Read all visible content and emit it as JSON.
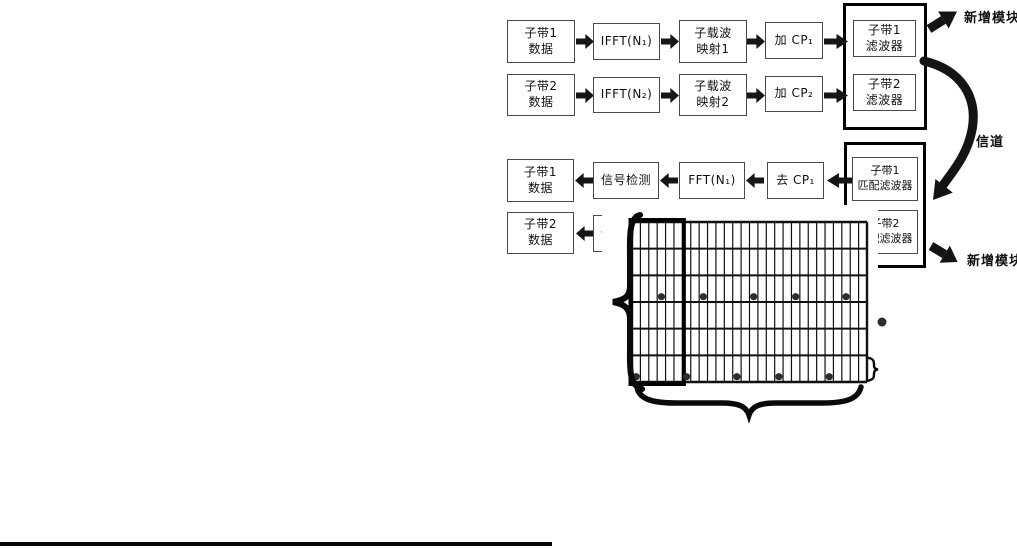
{
  "diagram": {
    "transmitter": {
      "chains": [
        {
          "boxes": [
            "子带1\n数据",
            "IFFT(N₁)",
            "子载波\n映射1",
            "加 CP₁",
            "子带1\n滤波器"
          ]
        },
        {
          "boxes": [
            "子带2\n数据",
            "IFFT(N₂)",
            "子载波\n映射2",
            "加 CP₂",
            "子带2\n滤波器"
          ]
        }
      ],
      "new_module_label": "新增模块"
    },
    "channel_label": "信道",
    "receiver": {
      "chains": [
        {
          "boxes": [
            "子带1\n数据",
            "信号检测",
            "FFT(N₁)",
            "去 CP₁",
            "子带1\n匹配滤波器"
          ]
        },
        {
          "boxes": [
            "子带2\n数据",
            "信号检测",
            "FFT(N₂)",
            "去 CP₂",
            "子带2\n匹配滤波器"
          ]
        }
      ],
      "new_module_label": "新增模块"
    },
    "resource_grid": {
      "columns": 28,
      "rows": 6,
      "highlighted_block_columns": 6,
      "pilot_dots": [
        {
          "row": 3,
          "cols": [
            4,
            9,
            15,
            20,
            26
          ]
        },
        {
          "row": 6,
          "cols": [
            1,
            7,
            13,
            18,
            24
          ]
        }
      ],
      "has_legend_dot": true
    },
    "colors": {
      "line": "#111111",
      "dot": "#2e2e2e",
      "box_border": "#4a4a4a"
    }
  }
}
